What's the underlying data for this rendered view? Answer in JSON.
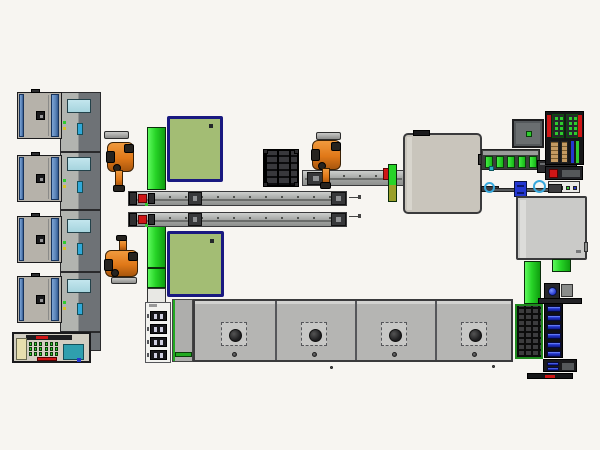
{
  "scene": {
    "kind": "factory-line-top-view",
    "visible_text": "none"
  },
  "colors": {
    "background": "#f7f5f1",
    "machine_gray": "#b6b2aa",
    "machine_gray_light": "#c9c5bc",
    "panel_gray": "#cacac8",
    "accent_blue": "#5b84b8",
    "screen_blue": "#a6d4de",
    "navy_border": "#191980",
    "olive_green": "#a3bd74",
    "bright_green": "#27d427",
    "led_green": "#2ecc2e",
    "robot_orange": "#e07818",
    "alarm_red": "#cf1616",
    "teal": "#2f9fae",
    "tan": "#c49a62",
    "royal_blue": "#2336d0",
    "pale_yellow": "#e7dfae"
  },
  "components": {
    "left_station_machines": 4,
    "left_rail_stations": 4,
    "robots": 3,
    "buffer_strips": 2,
    "green_panels": 2,
    "twin_transfer_rails": 2,
    "rail_end_markers": 2,
    "pallet_trays": 1,
    "process_cells_right": 2,
    "green_roller_segments": 5,
    "bottom_press_stations": 4,
    "connector_blocks": 4,
    "blue_bus_bars": 6,
    "led_dots_per_block": 8
  }
}
